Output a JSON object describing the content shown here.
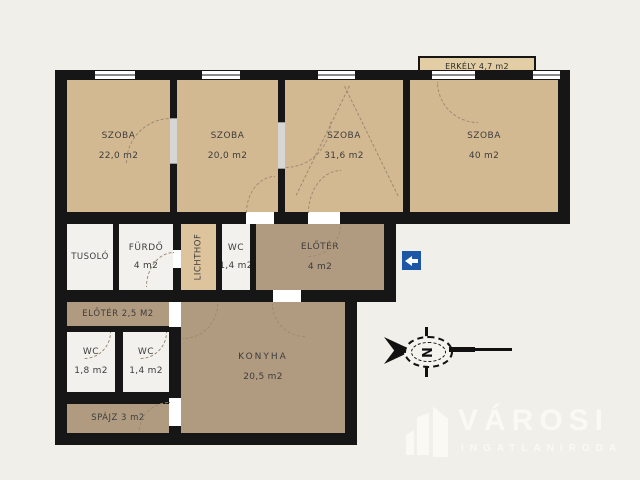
{
  "rooms": {
    "szoba1": {
      "label": "SZOBA",
      "area": "22,0 m2"
    },
    "szoba2": {
      "label": "SZOBA",
      "area": "20,0 m2"
    },
    "szoba3": {
      "label": "SZOBA",
      "area": "31,6 m2"
    },
    "szoba4": {
      "label": "SZOBA",
      "area": "40 m2"
    },
    "erkely": {
      "label": "ERKÉLY 4,7 m2"
    },
    "tusolo": {
      "label": "TUSOLÓ"
    },
    "furdo": {
      "label": "FÜRDŐ",
      "area": "4 m2"
    },
    "lichthof": {
      "label": "LICHTHOF"
    },
    "wc_mid": {
      "label": "WC",
      "area": "1,4 m2"
    },
    "eloter": {
      "label": "ELŐTÉR",
      "area": "4 m2"
    },
    "eloter2": {
      "label": "ELŐTÉR 2,5 M2"
    },
    "wc_left": {
      "label": "WC",
      "area": "1,8 m2"
    },
    "wc_right": {
      "label": "WC",
      "area": "1,4 m2"
    },
    "spajz": {
      "label": "SPÁJZ 3 m2"
    },
    "konyha": {
      "label": "KONYHA",
      "area": "20,5 m2"
    }
  },
  "compass": {
    "letter": "N"
  },
  "entrance_arrow": {
    "direction": "left"
  },
  "logo": {
    "title": "VÁROSI",
    "subtitle": "INGATLANIRODA"
  },
  "colors": {
    "background": "#f0efe9",
    "wall": "#161616",
    "room_tan": "#d3b992",
    "room_dark": "#b19b80",
    "room_light": "#f2f1ed",
    "lichthof": "#dec49c",
    "balcony": "#e3cda4",
    "entrance_sign_blue": "#1e56a6",
    "logo_white": "#faf9f3"
  }
}
